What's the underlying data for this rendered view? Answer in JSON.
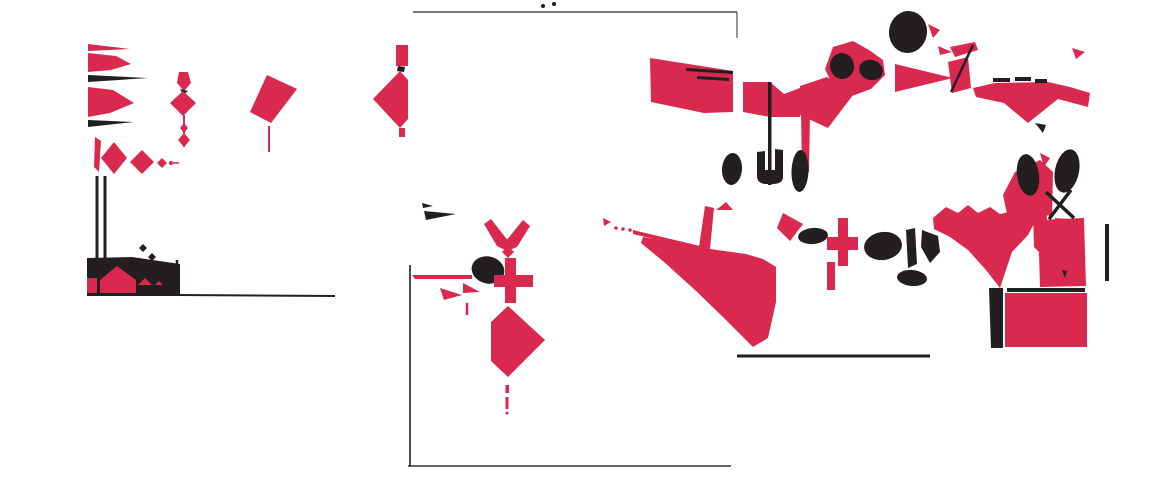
{
  "canvas": {
    "width": 1160,
    "height": 480,
    "background": "#ffffff"
  },
  "palette": {
    "red": "#D9294E",
    "black": "#231E20",
    "dim": "rgba(30,25,27,0.78)"
  },
  "shapes": [
    {
      "type": "polygon",
      "fill": "red",
      "points": "88,44 130,49 88,51"
    },
    {
      "type": "polygon",
      "fill": "red",
      "points": "88,53 116,56 131,64 111,70 88,72"
    },
    {
      "type": "polygon",
      "fill": "black",
      "points": "88,75 148,78 88,82"
    },
    {
      "type": "polygon",
      "fill": "red",
      "points": "88,87 113,90 134,103 110,113 88,117"
    },
    {
      "type": "polygon",
      "fill": "black",
      "points": "88,120 134,122 88,127"
    },
    {
      "type": "polygon",
      "fill": "red",
      "points": "179,72 188,72 191,83 184,91 177,83"
    },
    {
      "type": "polygon",
      "fill": "black",
      "points": "180,89 188,91 183,95"
    },
    {
      "type": "polygon",
      "fill": "red",
      "points": "183,91 196,103 183,116 170,103"
    },
    {
      "type": "line",
      "stroke": "red",
      "w": 2,
      "x1": 184,
      "y1": 115,
      "x2": 184,
      "y2": 147
    },
    {
      "type": "polygon",
      "fill": "red",
      "points": "184,123 188,128 184,133 180,128"
    },
    {
      "type": "polygon",
      "fill": "red",
      "points": "184,133 190,140 184,147 178,140"
    },
    {
      "type": "polygon",
      "fill": "red",
      "points": "267,75 297,89 271,123 250,112"
    },
    {
      "type": "line",
      "stroke": "red",
      "w": 2,
      "x1": 269,
      "y1": 126,
      "x2": 269,
      "y2": 152
    },
    {
      "type": "polygon",
      "fill": "red",
      "points": "95,137 101,141 99,172 94,167"
    },
    {
      "type": "polygon",
      "fill": "red",
      "points": "114,142 127,158 114,174 101,158"
    },
    {
      "type": "polygon",
      "fill": "red",
      "points": "142,150 154,162 142,174 130,162"
    },
    {
      "type": "polygon",
      "fill": "red",
      "points": "162,158 167,163 162,168 157,163"
    },
    {
      "type": "circle",
      "fill": "red",
      "cx": 171,
      "cy": 163,
      "r": 2
    },
    {
      "type": "line",
      "stroke": "red",
      "w": 1.5,
      "x1": 173,
      "y1": 163,
      "x2": 179,
      "y2": 163
    },
    {
      "type": "line",
      "stroke": "black",
      "w": 3,
      "x1": 97,
      "y1": 176,
      "x2": 97,
      "y2": 294
    },
    {
      "type": "line",
      "stroke": "black",
      "w": 3,
      "x1": 105,
      "y1": 176,
      "x2": 105,
      "y2": 262
    },
    {
      "type": "line",
      "stroke": "black",
      "w": 2.5,
      "x1": 177,
      "y1": 260,
      "x2": 177,
      "y2": 293
    },
    {
      "type": "polygon",
      "fill": "black",
      "points": "87,258 132,257 180,264 180,296 87,296"
    },
    {
      "type": "polygon",
      "fill": "red",
      "points": "117,266 136,280 136,293 100,293 100,280"
    },
    {
      "type": "rect",
      "fill": "red",
      "x": 87,
      "y": 278,
      "w": 10,
      "h": 15
    },
    {
      "type": "polygon",
      "fill": "red",
      "points": "138,285 145,278 152,285"
    },
    {
      "type": "polygon",
      "fill": "red",
      "points": "155,285 159,281 163,285"
    },
    {
      "type": "line",
      "stroke": "black",
      "w": 2,
      "x1": 180,
      "y1": 295,
      "x2": 335,
      "y2": 296
    },
    {
      "type": "polygon",
      "fill": "black",
      "points": "143,244 147,248 143,252 139,248"
    },
    {
      "type": "polygon",
      "fill": "black",
      "points": "152,253 156,257 152,261 148,257"
    },
    {
      "type": "line",
      "stroke": "dim",
      "w": 1.6,
      "x1": 413,
      "y1": 12,
      "x2": 737,
      "y2": 12
    },
    {
      "type": "line",
      "stroke": "dim",
      "w": 1.2,
      "x1": 737,
      "y1": 12,
      "x2": 737,
      "y2": 38
    },
    {
      "type": "line",
      "stroke": "dim",
      "w": 2,
      "x1": 410,
      "y1": 265,
      "x2": 410,
      "y2": 466
    },
    {
      "type": "line",
      "stroke": "dim",
      "w": 1.8,
      "x1": 408,
      "y1": 466,
      "x2": 731,
      "y2": 466
    },
    {
      "type": "circle",
      "fill": "black",
      "cx": 543,
      "cy": 6,
      "r": 2
    },
    {
      "type": "circle",
      "fill": "black",
      "cx": 554,
      "cy": 4,
      "r": 2
    },
    {
      "type": "rect",
      "fill": "red",
      "x": 396,
      "y": 45,
      "w": 12,
      "h": 21
    },
    {
      "type": "polygon",
      "fill": "black",
      "points": "398,66 405,67 404,72 397,71"
    },
    {
      "type": "polygon",
      "fill": "red",
      "points": "400,71 408,80 408,119 400,128 373,99"
    },
    {
      "type": "rect",
      "fill": "red",
      "x": 399,
      "y": 128,
      "w": 6,
      "h": 9
    },
    {
      "type": "polygon",
      "fill": "black",
      "points": "422,203 433,206 423,208"
    },
    {
      "type": "polygon",
      "fill": "black",
      "points": "424,211 456,214 426,220"
    },
    {
      "type": "polygon",
      "fill": "red",
      "points": "484,224 491,219 509,242 507,251 497,246"
    },
    {
      "type": "polygon",
      "fill": "red",
      "points": "530,226 523,220 505,242 507,251 517,247"
    },
    {
      "type": "polygon",
      "fill": "red",
      "points": "508,246 514,252 508,258 502,252"
    },
    {
      "type": "line",
      "stroke": "red",
      "w": 2,
      "x1": 507,
      "y1": 258,
      "x2": 507,
      "y2": 268
    },
    {
      "type": "ellipse",
      "fill": "black",
      "cx": 488,
      "cy": 270,
      "rx": 16.5,
      "ry": 13.5,
      "rot": 14
    },
    {
      "type": "polygon",
      "fill": "red",
      "points": "412,275 472,275 472,279 415,279"
    },
    {
      "type": "rect",
      "fill": "red",
      "x": 505,
      "y": 258,
      "w": 11,
      "h": 45
    },
    {
      "type": "rect",
      "fill": "red",
      "x": 494,
      "y": 275,
      "w": 39,
      "h": 12
    },
    {
      "type": "polygon",
      "fill": "red",
      "points": "463,283 480,292 463,293"
    },
    {
      "type": "polygon",
      "fill": "red",
      "points": "440,288 462,295 444,300"
    },
    {
      "type": "line",
      "stroke": "red",
      "w": 2.5,
      "x1": 467,
      "y1": 303,
      "x2": 467,
      "y2": 315
    },
    {
      "type": "polygon",
      "fill": "red",
      "points": "508,306 545,340 508,377 491,361 491,322"
    },
    {
      "type": "rect",
      "fill": "red",
      "x": 505.5,
      "y": 385,
      "w": 3.5,
      "h": 8
    },
    {
      "type": "rect",
      "fill": "red",
      "x": 505.5,
      "y": 397,
      "w": 3,
      "h": 12
    },
    {
      "type": "circle",
      "fill": "red",
      "cx": 507,
      "cy": 413,
      "r": 1.5
    },
    {
      "type": "polygon",
      "fill": "red",
      "points": "603,218 611,222 604,226"
    },
    {
      "type": "circle",
      "fill": "red",
      "cx": 616,
      "cy": 228,
      "r": 1.8
    },
    {
      "type": "circle",
      "fill": "red",
      "cx": 623,
      "cy": 229,
      "r": 1.8
    },
    {
      "type": "circle",
      "fill": "red",
      "cx": 630,
      "cy": 230,
      "r": 1.8
    },
    {
      "type": "polygon",
      "fill": "red",
      "points": "633,230 700,246 700,250 633,234"
    },
    {
      "type": "polygon",
      "fill": "red",
      "points": "643,237 699,247 705,206 714,208 710,249 746,254 763,259 776,267 776,302 768,338 753,347 724,318 695,290 664,262 641,243"
    },
    {
      "type": "line",
      "stroke": "black",
      "w": 3,
      "x1": 737,
      "y1": 356,
      "x2": 930,
      "y2": 356
    },
    {
      "type": "polygon",
      "fill": "red",
      "points": "650,58 733,71 733,112 704,113 651,102"
    },
    {
      "type": "polygon",
      "fill": "black",
      "points": "686,68 733,71 733,74 686,71"
    },
    {
      "type": "polygon",
      "fill": "black",
      "points": "697,76 729,78 729,81 697,79"
    },
    {
      "type": "polygon",
      "fill": "red",
      "points": "743,82 770,82 784,94 800,88 800,117 770,117 743,112"
    },
    {
      "type": "polygon",
      "fill": "red",
      "points": "800,86 827,77 853,95 828,128 800,115"
    },
    {
      "type": "rect",
      "fill": "black",
      "x": 768,
      "y": 82,
      "w": 3.5,
      "h": 103
    },
    {
      "type": "polygon",
      "fill": "red",
      "points": "801,112 810,114 809,172 802,172"
    },
    {
      "type": "polygon",
      "fill": "red",
      "points": "833,47 853,41 869,50 883,60 885,75 871,89 852,96 834,88 825,69"
    },
    {
      "type": "ellipse",
      "fill": "black",
      "cx": 842,
      "cy": 66,
      "rx": 12,
      "ry": 13,
      "rot": -10
    },
    {
      "type": "ellipse",
      "fill": "black",
      "cx": 871,
      "cy": 70,
      "rx": 12,
      "ry": 10,
      "rot": 18
    },
    {
      "type": "polygon",
      "fill": "red",
      "points": "895,64 953,78 895,92"
    },
    {
      "type": "ellipse",
      "fill": "black",
      "cx": 908,
      "cy": 32,
      "rx": 19,
      "ry": 21,
      "rot": 8
    },
    {
      "type": "polygon",
      "fill": "red",
      "points": "928,24 940,30 933,38"
    },
    {
      "type": "polygon",
      "fill": "red",
      "points": "938,46 952,52 940,55"
    },
    {
      "type": "polygon",
      "fill": "red",
      "points": "950,47 975,42 978,50 955,57"
    },
    {
      "type": "polygon",
      "fill": "red",
      "points": "948,62 968,57 971,88 952,93"
    },
    {
      "type": "line",
      "stroke": "black",
      "w": 2.5,
      "x1": 973,
      "y1": 45,
      "x2": 951,
      "y2": 92
    },
    {
      "type": "polygon",
      "fill": "red",
      "points": "973,88 995,83 1048,82 1070,87 1090,93 1088,107 1058,99 1028,123 1004,103 976,97"
    },
    {
      "type": "rect",
      "fill": "black",
      "x": 993,
      "y": 78,
      "w": 17,
      "h": 4
    },
    {
      "type": "rect",
      "fill": "black",
      "x": 1015,
      "y": 77,
      "w": 16,
      "h": 4
    },
    {
      "type": "rect",
      "fill": "black",
      "x": 1035,
      "y": 79,
      "w": 12,
      "h": 4
    },
    {
      "type": "polygon",
      "fill": "black",
      "points": "1035,123 1046,125 1043,133"
    },
    {
      "type": "polygon",
      "fill": "red",
      "points": "1072,48 1085,52 1076,59"
    },
    {
      "type": "ellipse",
      "fill": "black",
      "cx": 732,
      "cy": 169,
      "rx": 10,
      "ry": 16,
      "rot": 4
    },
    {
      "type": "path",
      "fill": "black",
      "d": "M757,152 L765,151 L765,170 L775,170 L775,149 L783,150 L783,177 Q783,184 772,184 L765,184 Q757,183 757,176 Z"
    },
    {
      "type": "ellipse",
      "fill": "black",
      "cx": 800,
      "cy": 171,
      "rx": 8.5,
      "ry": 21,
      "rot": 2
    },
    {
      "type": "polygon",
      "fill": "red",
      "points": "716,210 726,202 733,210"
    },
    {
      "type": "polygon",
      "fill": "red",
      "points": "783,213 803,224 790,241 777,228"
    },
    {
      "type": "ellipse",
      "fill": "black",
      "cx": 813,
      "cy": 236,
      "rx": 15,
      "ry": 8,
      "rot": -5
    },
    {
      "type": "rect",
      "fill": "red",
      "x": 838,
      "y": 218,
      "w": 10,
      "h": 48
    },
    {
      "type": "rect",
      "fill": "red",
      "x": 827,
      "y": 237,
      "w": 31,
      "h": 13
    },
    {
      "type": "rect",
      "fill": "red",
      "x": 827,
      "y": 262,
      "w": 8,
      "h": 28
    },
    {
      "type": "ellipse",
      "fill": "black",
      "cx": 883,
      "cy": 246,
      "rx": 19,
      "ry": 14,
      "rot": -8
    },
    {
      "type": "polygon",
      "fill": "black",
      "points": "906,230 915,228 917,264 908,268"
    },
    {
      "type": "polygon",
      "fill": "black",
      "points": "922,230 938,236 940,252 930,263 921,247"
    },
    {
      "type": "ellipse",
      "fill": "black",
      "cx": 912,
      "cy": 278,
      "rx": 15,
      "ry": 8,
      "rot": 5
    },
    {
      "type": "path",
      "fill": "red",
      "d": "M933,218 L946,207 L958,213 L968,205 L978,213 L990,207 L1000,214 L1014,211 L1030,212 L1037,218 L1028,235 L1012,252 L1000,288 L986,270 L968,250 L950,237 L934,229 Z"
    },
    {
      "type": "polygon",
      "fill": "red",
      "points": "1003,195 1015,172 1040,160 1053,172 1052,216 1036,214 1018,216 1007,214"
    },
    {
      "type": "polygon",
      "fill": "red",
      "points": "1040,153 1050,158 1044,167"
    },
    {
      "type": "polygon",
      "fill": "red",
      "points": "1033,212 1047,212 1046,248 1040,253 1034,247"
    },
    {
      "type": "polygon",
      "fill": "red",
      "points": "1055,218 1068,219 1067,264 1061,270 1056,263"
    },
    {
      "type": "polygon",
      "fill": "red",
      "points": "1038,220 1084,218 1086,286 1040,287"
    },
    {
      "type": "line",
      "stroke": "black",
      "w": 4,
      "x1": 1007,
      "y1": 290,
      "x2": 1085,
      "y2": 290
    },
    {
      "type": "polygon",
      "fill": "red",
      "points": "1005,293 1087,293 1087,347 1005,347"
    },
    {
      "type": "polygon",
      "fill": "black",
      "points": "989,288 1003,288 1003,348 991,348"
    },
    {
      "type": "polygon",
      "fill": "black",
      "points": "1062,270 1067,271 1065,278"
    },
    {
      "type": "ellipse",
      "fill": "black",
      "cx": 1028,
      "cy": 175,
      "rx": 11,
      "ry": 21,
      "rot": -8
    },
    {
      "type": "ellipse",
      "fill": "black",
      "cx": 1067,
      "cy": 171,
      "rx": 12,
      "ry": 22,
      "rot": 12
    },
    {
      "type": "line",
      "stroke": "black",
      "w": 3.5,
      "x1": 1046,
      "y1": 192,
      "x2": 1074,
      "y2": 218
    },
    {
      "type": "line",
      "stroke": "black",
      "w": 3.5,
      "x1": 1071,
      "y1": 190,
      "x2": 1049,
      "y2": 219
    },
    {
      "type": "rect",
      "fill": "black",
      "x": 1105,
      "y": 224,
      "w": 4,
      "h": 57
    }
  ]
}
